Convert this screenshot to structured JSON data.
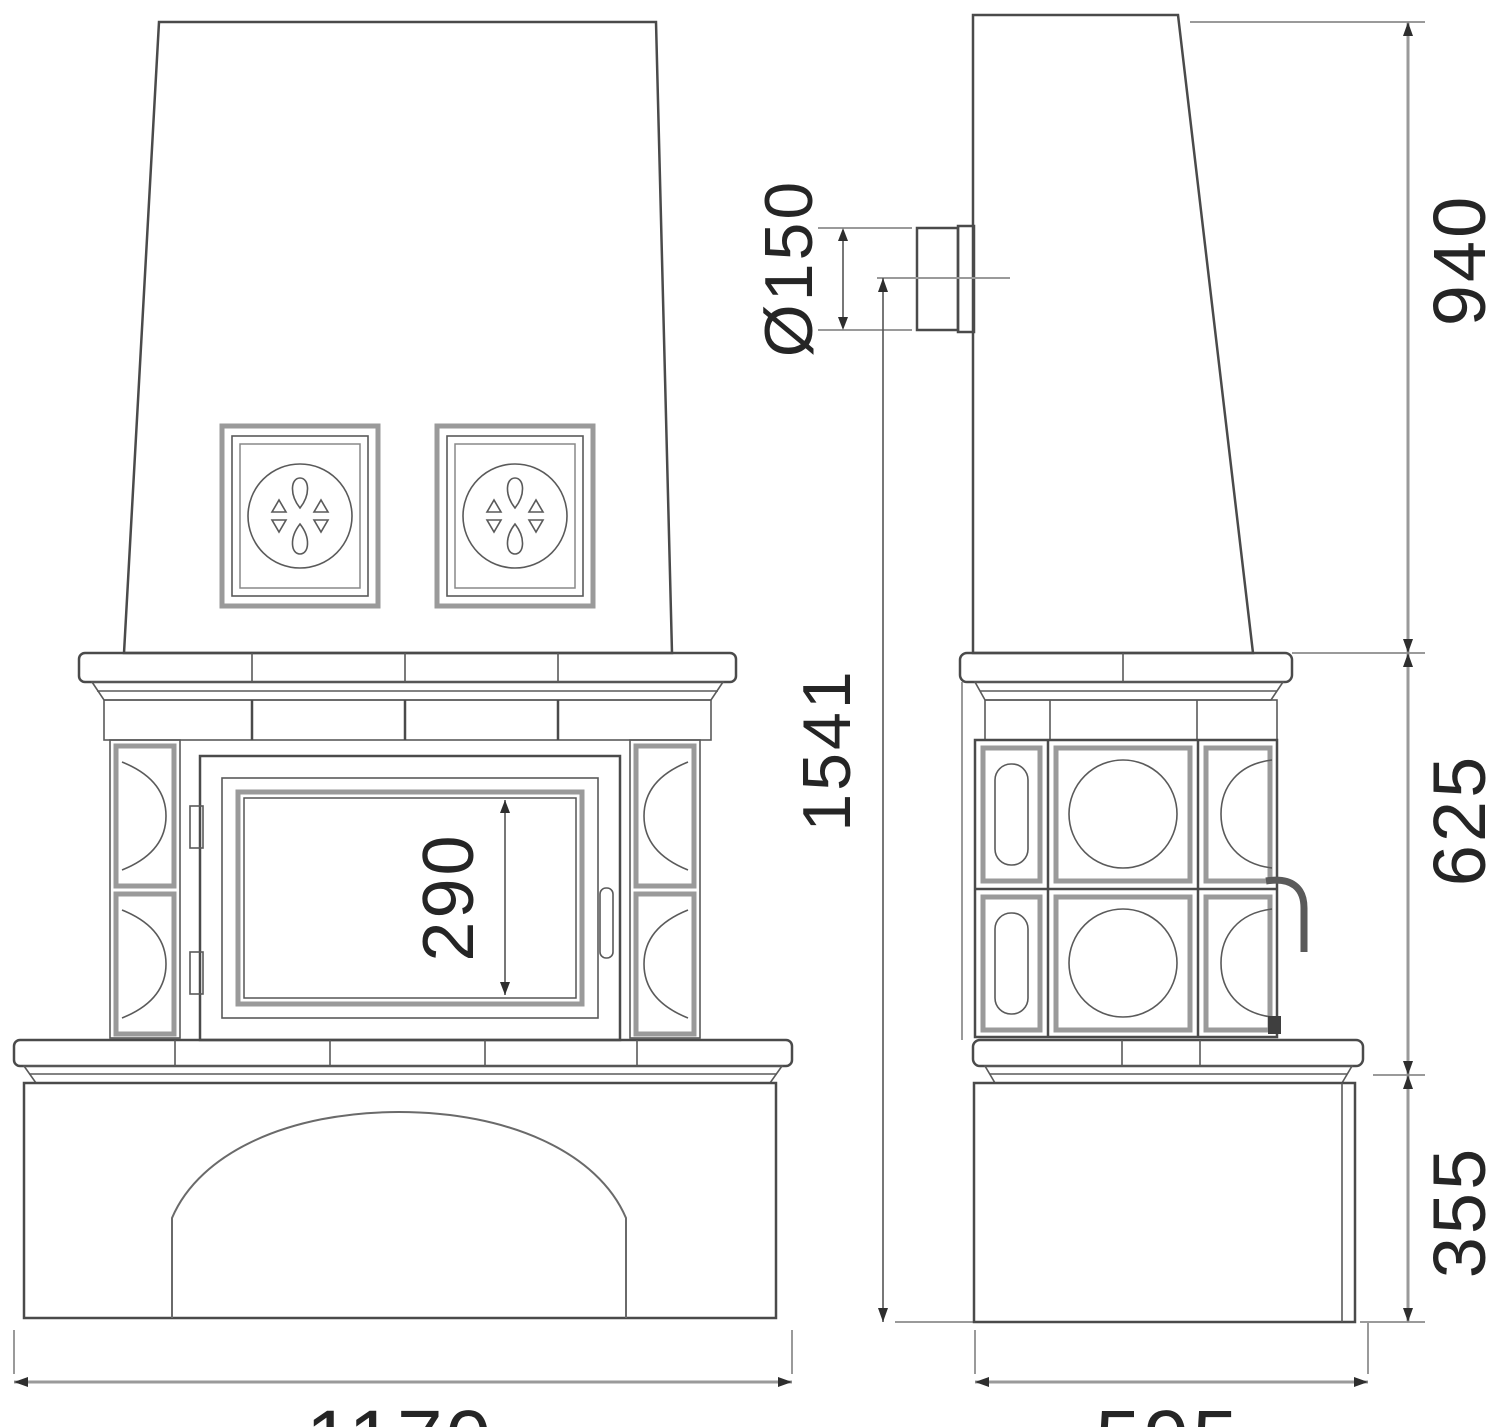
{
  "drawing": {
    "type": "technical-elevation",
    "subject": "tiled stove front and side views",
    "background": "#ffffff",
    "line_color": "#4a4a4a",
    "dimension_line_color": "#9a9a9a",
    "text_color": "#252525"
  },
  "dimensions": {
    "door_opening_height": "290",
    "overall_height_to_flue_center": "1541",
    "flue_diameter": "Ø150",
    "upper_section_height": "940",
    "middle_section_height": "625",
    "base_height": "355",
    "front_width": "1170",
    "side_depth": "595"
  }
}
